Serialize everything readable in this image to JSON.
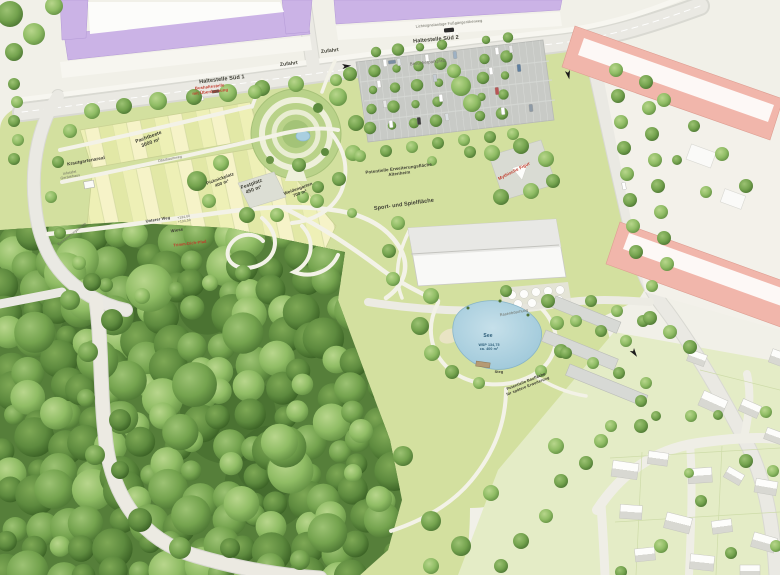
{
  "map": {
    "type": "landscape-masterplan-aerial",
    "labels": {
      "haltestelle_sued_1": "Haltestelle Süd 1",
      "bushaltestelle_rot": "Bushaltestelle\nmit Überdachung",
      "zufahrt_1": "Zufahrt",
      "zufahrt_2": "Zufahrt",
      "fussgaengerueberweg": "Lichtsignalanlage Fußgängerüberweg",
      "haltestelle_sued_2": "Haltestelle Süd 2",
      "besucherparkplatz": "Besucherparkplatz",
      "krautgartenareal": "Krautgartenareal",
      "infotafel": "Infotafel\nGerätehaus",
      "pachtbeete": "Pachtbeete\n3000 m²",
      "obstbaumweg": "Obstbaumweg",
      "picknickplatz": "Picknickplatz\n400 m²",
      "festplatz": "Festplatz\n450 m²",
      "weidengarten": "Weidengarten\n700 m²",
      "erweiterung": "Potentielle Erweiterungsfläche\nAltenheim",
      "sport_spiel": "Sport- und Spielfläche",
      "mythische_figur": "Mythische Figur",
      "unterer_weg": "Unterer Weg",
      "hoehen": "+134,00\n+134,50",
      "wiese": "Wiese",
      "trimm_pfad": "Trimm-Dich-Pfad",
      "see": "See",
      "see_detail": "WSP 134,75\nca. 400 m²",
      "steg": "Steg",
      "rasenboeschung": "Rasenböschung",
      "bauflaeche": "Potentielle Baufläche\nfür spätere Erweiterung",
      "entwaesserung": "Entwässerungsmulde"
    },
    "colors": {
      "lawn": "#d3e09f",
      "forest": "#567f3a",
      "road": "#eae9e3",
      "parking": "#c8cac6",
      "pond": "#a9cede",
      "garden_plots": "#eef0b6",
      "building_purple": "#cbb3e6",
      "building_pink": "#f1b6ab",
      "building_white": "#f8f8f6",
      "label_red": "#c03a2b",
      "label_blue": "#2c5d78"
    }
  }
}
